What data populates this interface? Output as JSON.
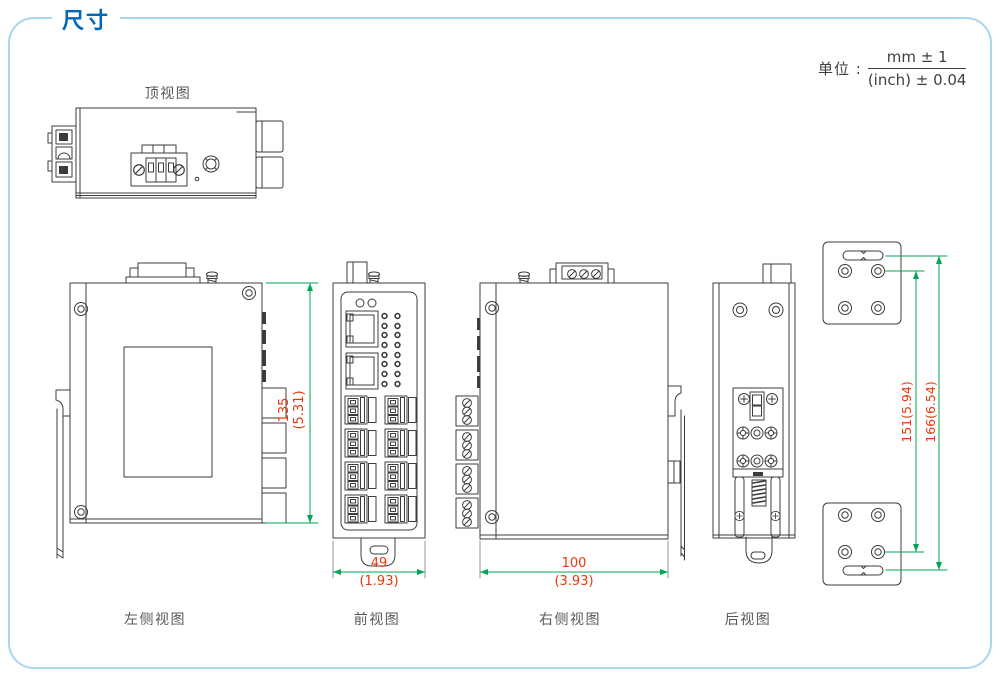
{
  "page": {
    "title": "尺寸",
    "unit": {
      "label": "单位 :",
      "numerator": "mm ± 1",
      "denominator": "(inch) ± 0.04"
    }
  },
  "views": {
    "top": "顶视图",
    "left": "左侧视图",
    "front": "前视图",
    "right": "右侧视图",
    "rear": "后视图"
  },
  "dimensions": {
    "height_mm": "135",
    "height_in": "(5.31)",
    "front_width_mm": "49",
    "front_width_in": "(1.93)",
    "depth_mm": "100",
    "depth_in": "(3.93)",
    "bracket_hole_span": "151(5.94)",
    "bracket_slot_span": "166(6.54)"
  },
  "colors": {
    "accent_blue": "#0068b6",
    "panel_border": "#a9d5ed",
    "dimension_text": "#e8380d",
    "dimension_line": "#00a651",
    "drawing_line": "#3c3c3c",
    "label_text": "#57585a"
  }
}
